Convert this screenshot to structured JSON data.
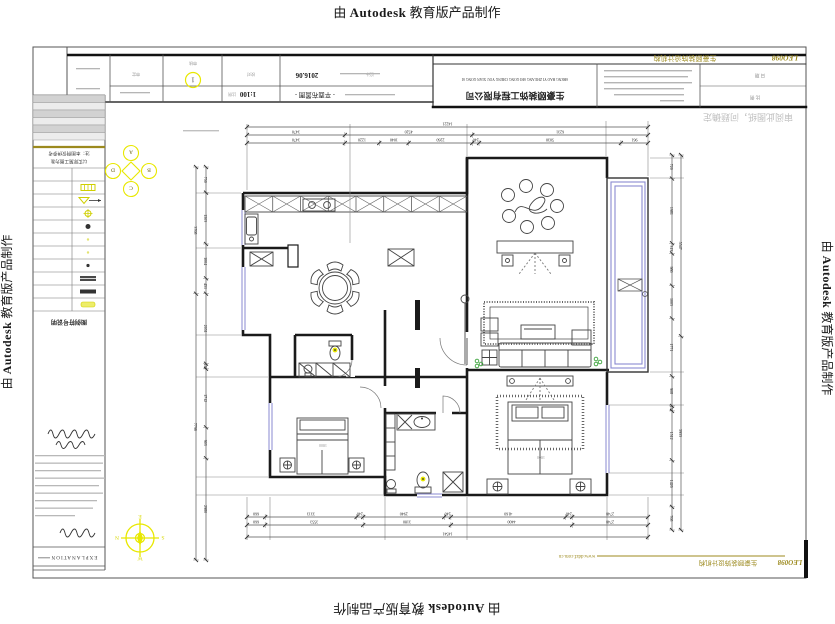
{
  "watermark": {
    "prefix": "由 ",
    "brand": "Autodesk",
    "suffix": " 教育版产品制作"
  },
  "titleblock": {
    "index": "1",
    "scale": "1:100",
    "scale_label": "比例",
    "drawing_title": "- 平面布置图 -",
    "date": "2016.06",
    "labels_row": [
      "审定",
      "审核",
      "校对",
      "设计"
    ],
    "company_cn": "生豪颐装饰工程有限公司",
    "company_en": "SHENG HAO YI ZHUANG SHI GONG CHENG YOU XIAN GONG SI",
    "brand_logo": "LEO098",
    "brand_name": "生豪颐装饰设计机构",
    "note": "审阅此图纸，问题确定",
    "field_labels": [
      "日 期",
      "比 例"
    ],
    "website": "www.ddzf.com.cn"
  },
  "legend": {
    "note1": "注：本图例仅供参考",
    "note2": "以实际施工图为准",
    "title": "图例符号说明",
    "explanation": "EXPLANATION",
    "rows": [
      {
        "symbol": "blank"
      },
      {
        "symbol": "grid-rect"
      },
      {
        "symbol": "valve-arrow"
      },
      {
        "symbol": "gear"
      },
      {
        "symbol": "dot"
      },
      {
        "symbol": "dot-pale"
      },
      {
        "symbol": "dot-pale"
      },
      {
        "symbol": "dot-dark"
      },
      {
        "symbol": "bar-striped"
      },
      {
        "symbol": "bar-dark"
      },
      {
        "symbol": "bar-yellow"
      }
    ]
  },
  "compass": {
    "n": "N",
    "e": "E",
    "s": "S",
    "w": "W"
  },
  "elevation_marker": {
    "letters": [
      "A",
      "B",
      "C",
      "D"
    ]
  },
  "plan": {
    "bed1_label": "1800",
    "bed2_label": "1800"
  },
  "dimensions": {
    "top": {
      "total": "14221",
      "row2": [
        "3470",
        "4520",
        "6231"
      ],
      "row3": [
        "3470",
        "1220",
        "1040",
        "2260",
        "240",
        "5030",
        "961"
      ]
    },
    "bottom": {
      "row1": [
        "660",
        "3313",
        "240",
        "2940",
        "240",
        "4160",
        "240",
        "2748"
      ],
      "row2": [
        "660",
        "3553",
        "3180",
        "4400",
        "2748"
      ],
      "total": "14541"
    },
    "left": {
      "outer": [
        "3708",
        "7796"
      ],
      "inner": [
        "750",
        "1503",
        "1004",
        "451",
        "2051",
        "150",
        "1712",
        "903",
        "2980"
      ]
    },
    "right": {
      "outer": [
        "5547",
        "5933"
      ],
      "inner": [
        "720",
        "1981",
        "313",
        "986",
        "1003",
        "1771",
        "908",
        "152",
        "1512",
        "1426",
        "708"
      ]
    }
  },
  "colors": {
    "accent_yellow": "#e8e800",
    "olive": "#9c8a1e",
    "window_blue": "#8a8ad0",
    "plant_green": "#3aa33a",
    "wall": "#1a1a1a"
  }
}
